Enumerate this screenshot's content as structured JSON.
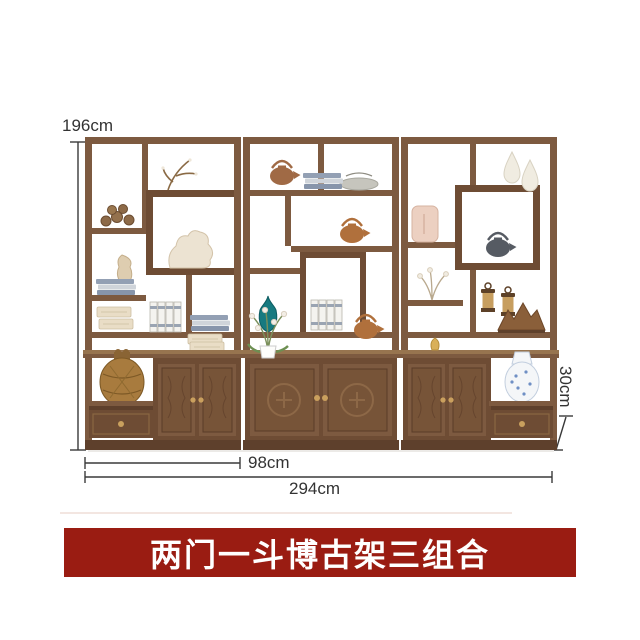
{
  "alt": "three-unit chinese antique curio display shelf with lattice compartments, two-door carved cabinets and one drawer per side unit, decorated with teapots, vases, books and ornaments",
  "dims": {
    "height": "196cm",
    "unit_width": "98cm",
    "total_width": "294cm",
    "depth": "30cm"
  },
  "banner": {
    "label": "两门一斗博古架三组合"
  },
  "colors": {
    "banner_bg": "#9a1c12",
    "banner_text": "#ffffff",
    "wood_main": "#7d5a40",
    "wood_dark": "#5e402c",
    "wood_mid": "#6e4c34",
    "wood_light": "#97744f",
    "dim_line": "#3a3a3a",
    "dim_text": "#333333",
    "page_bg": "#ffffff"
  }
}
